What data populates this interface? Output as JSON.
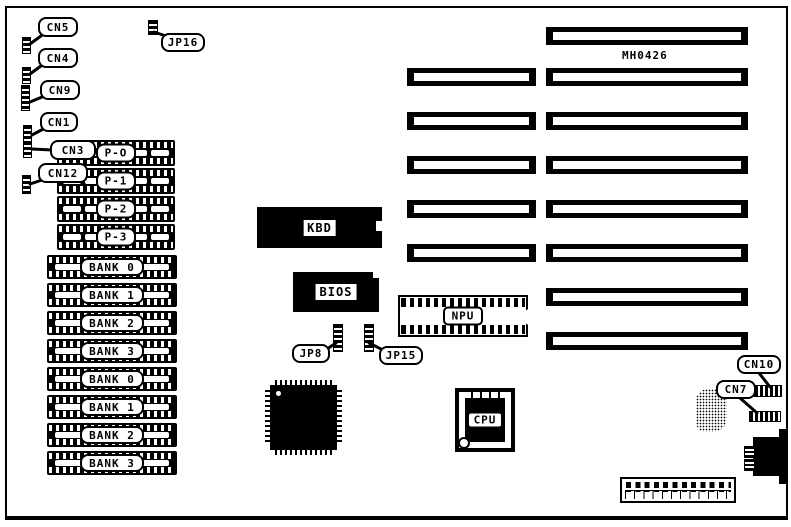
{
  "board": {
    "part_number": "MH0426"
  },
  "connectors": {
    "cn5": "CN5",
    "cn4": "CN4",
    "cn9": "CN9",
    "cn1": "CN1",
    "cn3": "CN3",
    "cn12": "CN12",
    "cn10": "CN10",
    "cn7": "CN7"
  },
  "jumpers": {
    "jp16": "JP16",
    "jp8": "JP8",
    "jp15": "JP15"
  },
  "memory": {
    "p_labels": [
      "P-O",
      "P-1",
      "P-2",
      "P-3"
    ],
    "bank_labels": [
      "BANK 0",
      "BANK 1",
      "BANK 2",
      "BANK 3",
      "BANK 0",
      "BANK 1",
      "BANK 2",
      "BANK 3"
    ]
  },
  "chips": {
    "kbd": "KBD",
    "bios": "BIOS",
    "npu": "NPU",
    "cpu": "CPU"
  }
}
